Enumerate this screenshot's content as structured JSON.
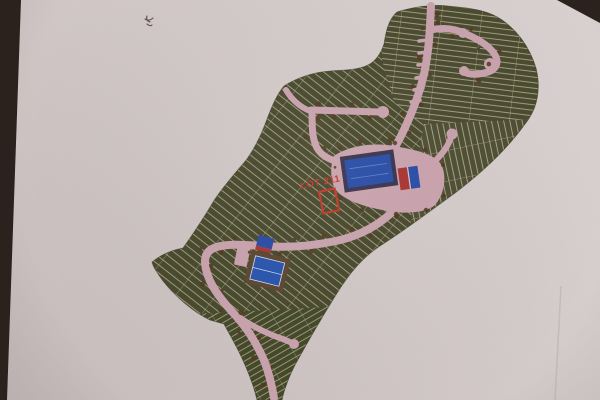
{
  "scene": {
    "kind": "photograph of a printed subdivision site plan lying on a dark table",
    "table_color": "#2b211d",
    "paper_color": "#cfc6c5"
  },
  "map": {
    "lot_label": "LOT 211",
    "colors": {
      "land": "#494a2f",
      "lot_line": "#b8b496",
      "road": "#c9a3ae",
      "water": "#2b4da6",
      "court": "#2b55ae",
      "court_pad": "#5c4733",
      "highlight": "#c2372a",
      "tree": "#53381f",
      "building_red": "#aa3530",
      "building_blue": "#2b4da6"
    },
    "features": {
      "pool": "swimming-pool",
      "clubhouse": "clubhouse",
      "tennis_court": "tennis-court",
      "highlighted_lot": "LOT 211"
    },
    "annotation": {
      "handwritten_mark": "illegible pencil mark"
    }
  }
}
